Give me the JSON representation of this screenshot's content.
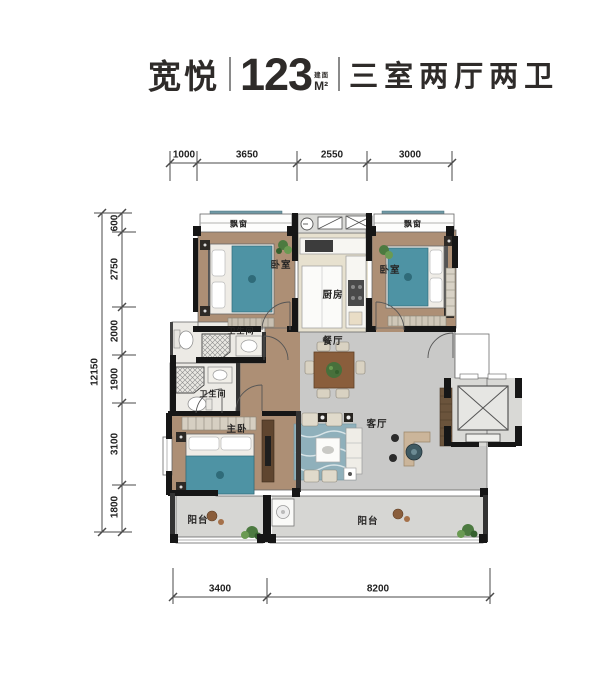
{
  "title": {
    "name": "宽悦",
    "area": "123",
    "area_prefix": "建面",
    "area_unit": "M²",
    "layout": "三室两厅两卫"
  },
  "dimensions": {
    "top": [
      "1000",
      "3650",
      "2550",
      "3000"
    ],
    "left_total": "12150",
    "left": [
      "600",
      "2750",
      "2000",
      "1900",
      "3100",
      "1800"
    ],
    "bottom": [
      "3400",
      "8200"
    ]
  },
  "rooms": {
    "bay_window_left": "飘窗",
    "bedroom_left": "卧室",
    "kitchen": "厨房",
    "bay_window_right": "飘窗",
    "bedroom_right": "卧室",
    "bathroom_upper": "卫生间",
    "dining_room": "餐厅",
    "bathroom_lower": "卫生间",
    "master_bedroom": "主卧",
    "living_room": "客厅",
    "balcony_left": "阳台",
    "balcony_right": "阳台"
  },
  "colors": {
    "wall": "#161616",
    "wood_floor": "#ad8f75",
    "gray_floor": "#c9c9c8",
    "balcony_floor": "#d6d6d3",
    "kitchen_floor": "#e7e1cf",
    "bath_floor": "#eceae5",
    "bed_teal": "#4e93a4",
    "dining_table": "#8a5e3c",
    "rug": "#8fb0bb",
    "plant": "#4c7a40",
    "dimension_line": "#4a4a4a",
    "title_text": "#2e2b29"
  }
}
